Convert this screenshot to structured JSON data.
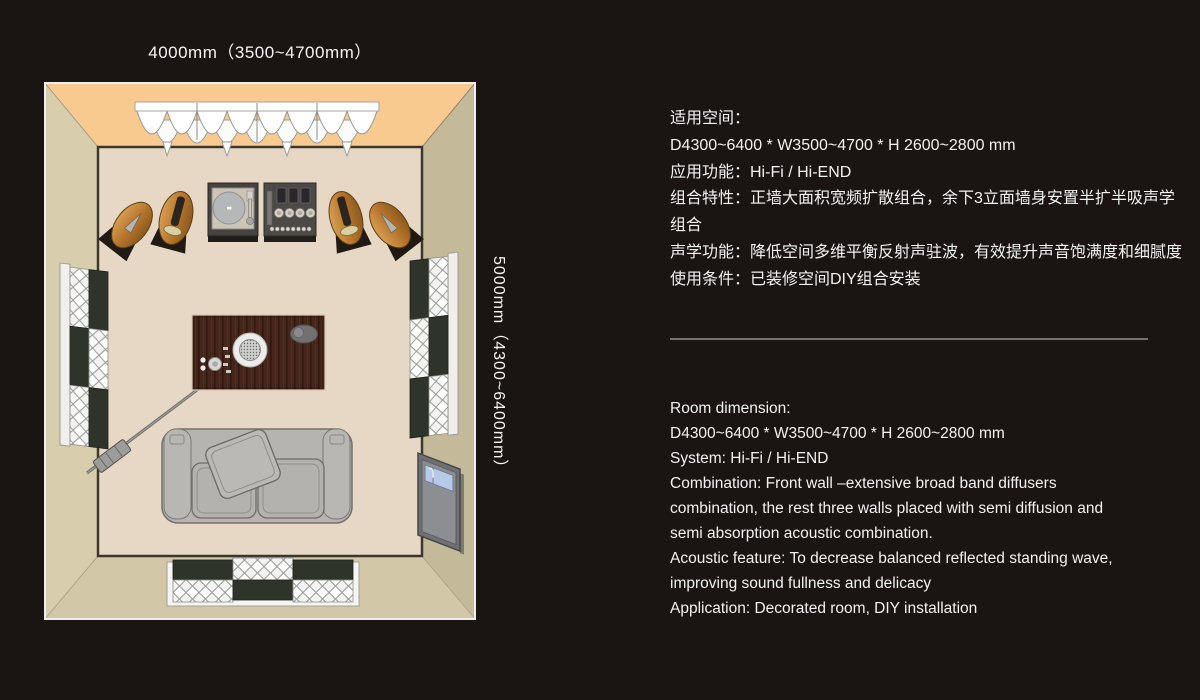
{
  "floor_plan": {
    "width_label": "4000mm（3500~4700mm）",
    "depth_label": "5000mm（4300~6400mm）"
  },
  "spec_cn": {
    "lines": [
      "适用空间：",
      "D4300~6400 * W3500~4700 * H 2600~2800 mm",
      "应用功能：Hi-Fi / Hi-END",
      "组合特性：正墙大面积宽频扩散组合，余下3立面墙身安置半扩半吸声学",
      "组合",
      "声学功能：降低空间多维平衡反射声驻波，有效提升声音饱满度和细腻度",
      "使用条件：已装修空间DIY组合安装"
    ]
  },
  "spec_en": {
    "lines": [
      "Room dimension:",
      "D4300~6400 * W3500~4700 * H 2600~2800 mm",
      "System: Hi-Fi / Hi-END",
      "Combination: Front wall –extensive broad band diffusers",
      "combination, the rest three walls placed with semi diffusion and",
      "semi absorption acoustic combination.",
      "Acoustic feature: To decrease balanced reflected standing wave,",
      "improving sound fullness and delicacy",
      "Application: Decorated room, DIY installation"
    ]
  },
  "colors": {
    "background": "#1a1513",
    "front_wall": "#f8ca90",
    "side_wall": "#cfc5a3",
    "floor": "#e7d8c5",
    "text": "#f2f2f2",
    "divider": "#737373"
  }
}
